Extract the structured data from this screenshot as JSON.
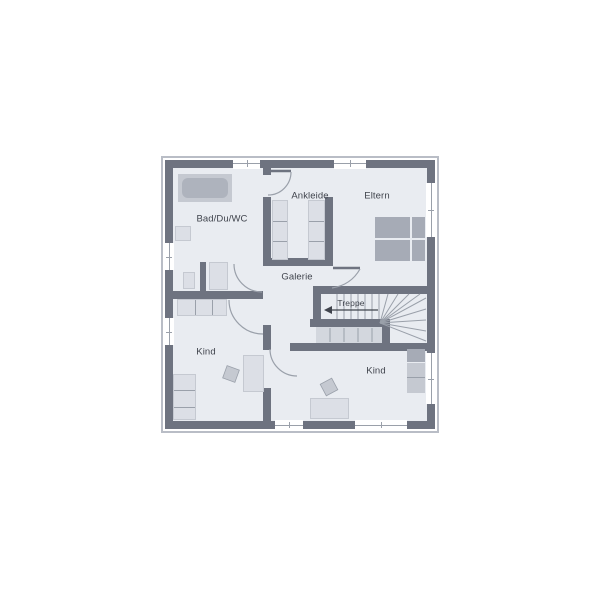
{
  "rooms": {
    "bad": {
      "label": "Bad/Du/WC"
    },
    "ankleide": {
      "label": "Ankleide"
    },
    "eltern": {
      "label": "Eltern"
    },
    "galerie": {
      "label": "Galerie"
    },
    "treppe": {
      "label": "Treppe"
    },
    "kind_left": {
      "label": "Kind"
    },
    "kind_right": {
      "label": "Kind"
    }
  },
  "colors": {
    "wall": "#6e7380",
    "floor": "#e9ecf1",
    "outline": "#b9bdc6",
    "line": "#9aa0aa",
    "text": "#40444d",
    "bg": "#ffffff",
    "furn_light": "#dcdfe6",
    "furn_med": "#c5c9d1",
    "furn_dark": "#a6abb6",
    "tub_inner": "#aeb3bd",
    "stair_fill": "#d3d7de"
  }
}
